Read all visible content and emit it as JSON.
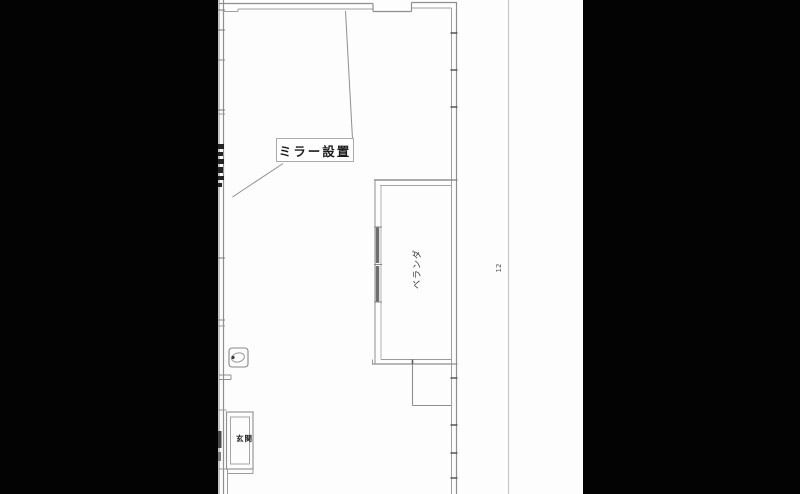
{
  "floorplan": {
    "mirror_label": "ミラー設置",
    "balcony_label": "ベランダ",
    "entrance_label": "玄関",
    "dimension_value": "12"
  },
  "colors": {
    "letterbox": "#030303",
    "paper": "#fdfdfd",
    "wall_line": "#8f8f8f",
    "wall_line_light": "#a8a8a8",
    "wall_joint_dark": "#565656",
    "sash_dark": "#6e6e6e",
    "label_text": "#1c1c1c",
    "dimension_line": "#c8c8c8"
  }
}
